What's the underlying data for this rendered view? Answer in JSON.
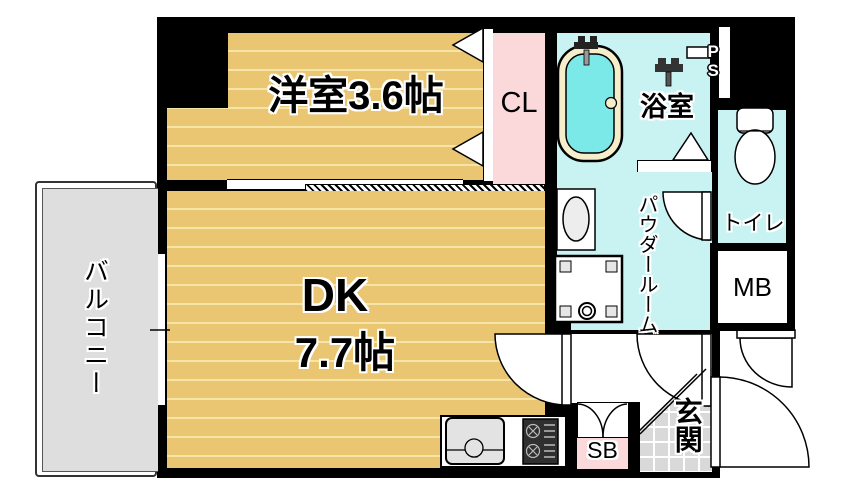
{
  "floorplan": {
    "type": "apartment-floor-plan",
    "rooms": {
      "western_room": "洋室3.6帖",
      "dk_name": "DK",
      "dk_size": "7.7帖",
      "balcony": "バルコニー",
      "bathroom": "浴室",
      "closet": "CL",
      "powder_room": "パウダールーム",
      "toilet": "トイレ",
      "meter_box": "MB",
      "shoe_box": "SB",
      "entrance": "玄関",
      "pipe_space": "PS"
    },
    "colors": {
      "wall": "#000000",
      "flooring": "#eac673",
      "flooring_stripe": "#f6e5a8",
      "wet_area_floor": "#c9f3f3",
      "closet_pink": "#fbd9db",
      "balcony_gray": "#dedede",
      "entrance_tile": "#d9d9d9",
      "tub_water": "#7ce9e9",
      "tub_rim": "#f4eecb"
    }
  }
}
